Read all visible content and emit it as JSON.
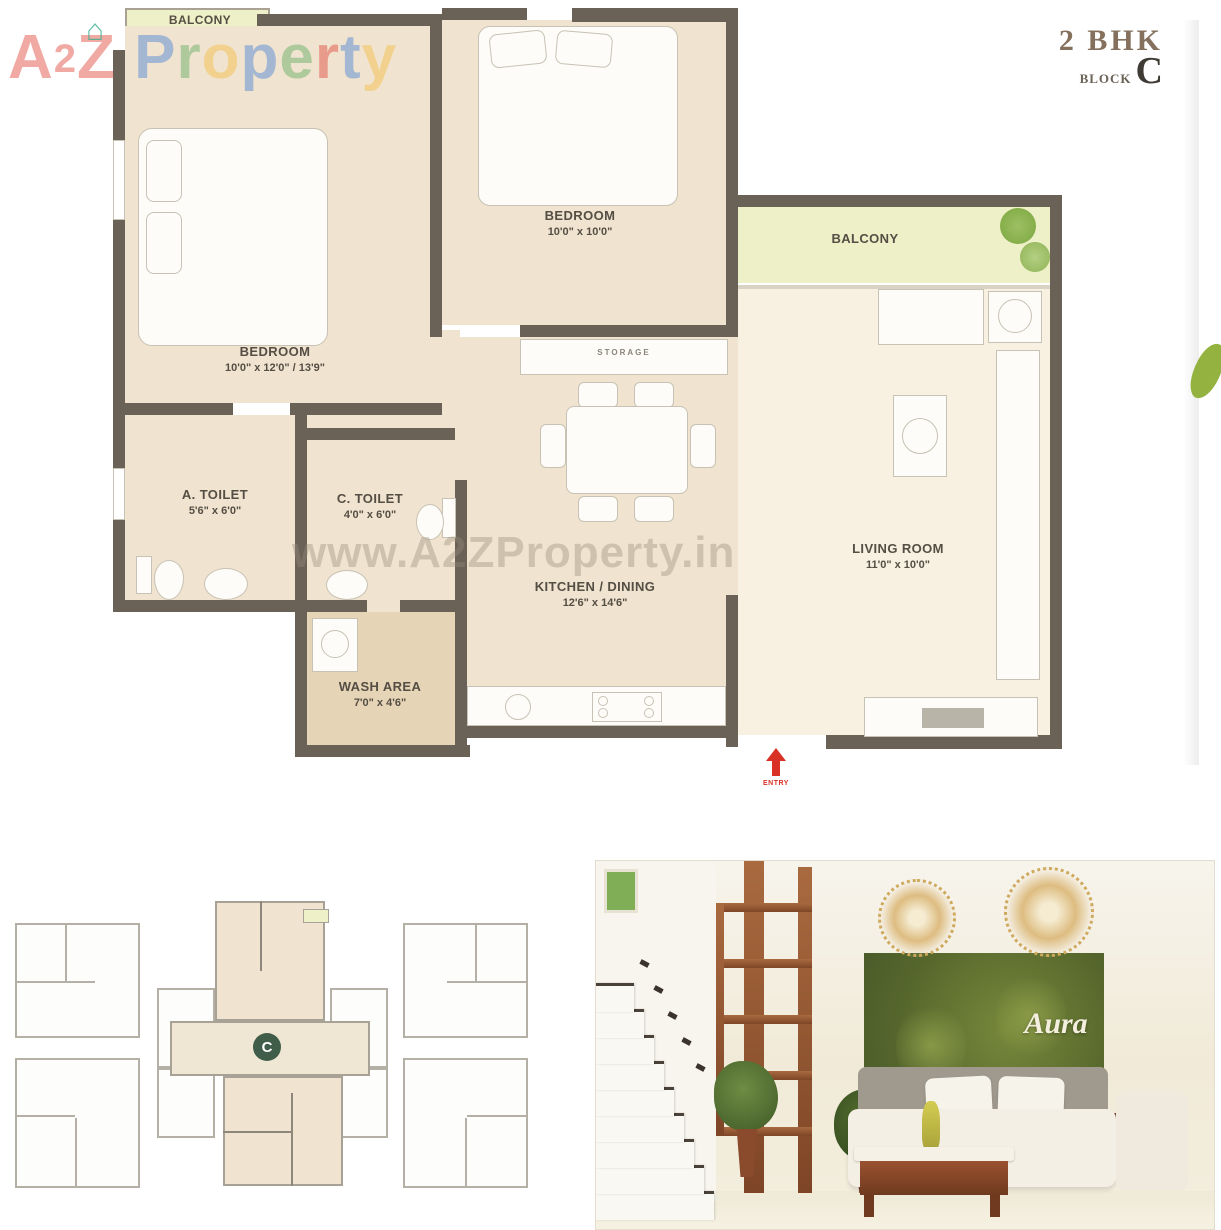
{
  "logo": {
    "letters": [
      {
        "ch": "A",
        "style": "color:#e2554a"
      },
      {
        "ch": "2",
        "style": "color:#e2554a"
      },
      {
        "ch": "Z",
        "style": "color:#e2554a"
      },
      {
        "ch": "P",
        "style": "color:#5b8dd6"
      },
      {
        "ch": "r",
        "style": "color:#6fb36a"
      },
      {
        "ch": "o",
        "style": "color:#f2c14e"
      },
      {
        "ch": "p",
        "style": "color:#5b8dd6"
      },
      {
        "ch": "e",
        "style": "color:#6fb36a"
      },
      {
        "ch": "r",
        "style": "color:#e2554a"
      },
      {
        "ch": "t",
        "style": "color:#5b8dd6"
      },
      {
        "ch": "y",
        "style": "color:#f2c14e"
      }
    ]
  },
  "plan": {
    "title": "2 BHK",
    "block_label": "BLOCK",
    "block_letter": "C"
  },
  "watermark": "www.A2ZProperty.in",
  "rooms": [
    {
      "id": "balcony-top",
      "label": "BALCONY",
      "dims": ""
    },
    {
      "id": "bedroom-left",
      "label": "BEDROOM",
      "dims": "10'0\" x 12'0\" / 13'9\""
    },
    {
      "id": "bedroom-top",
      "label": "BEDROOM",
      "dims": "10'0\" x 10'0\""
    },
    {
      "id": "balcony-right",
      "label": "BALCONY",
      "dims": ""
    },
    {
      "id": "a-toilet",
      "label": "A. TOILET",
      "dims": "5'6\" x 6'0\""
    },
    {
      "id": "c-toilet",
      "label": "C. TOILET",
      "dims": "4'0\" x 6'0\""
    },
    {
      "id": "kitchen-dining",
      "label": "KITCHEN / DINING",
      "dims": "12'6\" x 14'6\""
    },
    {
      "id": "living-room",
      "label": "LIVING ROOM",
      "dims": "11'0\" x 10'0\""
    },
    {
      "id": "wash-area",
      "label": "WASH AREA",
      "dims": "7'0\" x 4'6\""
    }
  ],
  "labels": {
    "storage": "STORAGE",
    "entry": "ENTRY"
  },
  "keyplan": {
    "marker": "C"
  },
  "photo": {
    "brand": "Aura"
  },
  "colors": {
    "wall": "#6b6257",
    "floor": "#f0e3cf",
    "balcony": "#eef0c8",
    "living": "#f8f0e1",
    "wash": "#e6d4b6",
    "accent_red": "#d93025",
    "green_wall": "#55662c",
    "wood": "#94512e",
    "keyplan_line": "#b5b0a6"
  }
}
